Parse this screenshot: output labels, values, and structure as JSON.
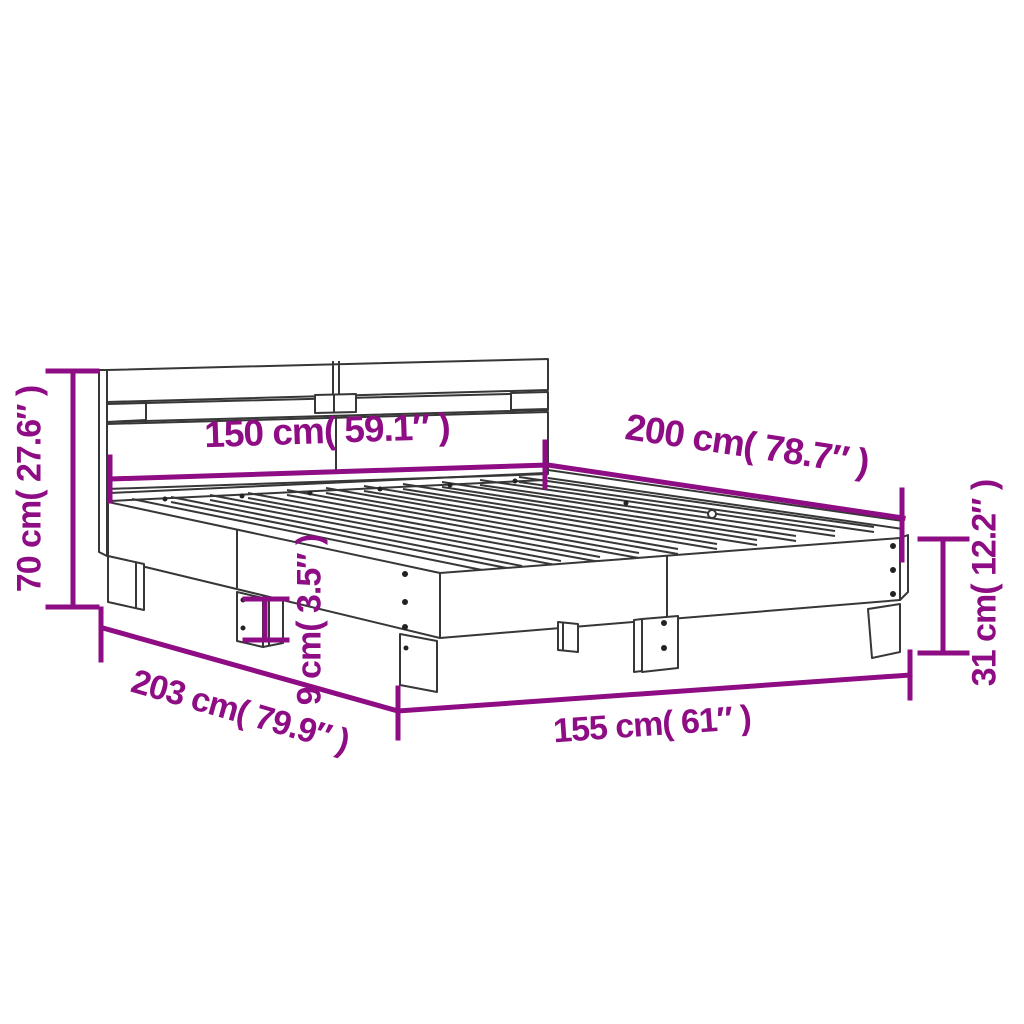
{
  "diagram": {
    "title": "Bed frame with headboard — dimension diagram",
    "colors": {
      "dimension_accent": "#8E0C84",
      "line_art": "#373737",
      "background": "#FFFFFF"
    },
    "dimensions": {
      "headboard_height": "70 cm( 27.6″ )",
      "bed_width": "150 cm( 59.1″ )",
      "bed_length": "200 cm( 78.7″ )",
      "frame_height": "31 cm( 12.2″ )",
      "slat_frame_height": "9 cm( 3.5″ )",
      "total_length": "203 cm( 79.9″ )",
      "total_width": "155 cm( 61″ )"
    }
  }
}
